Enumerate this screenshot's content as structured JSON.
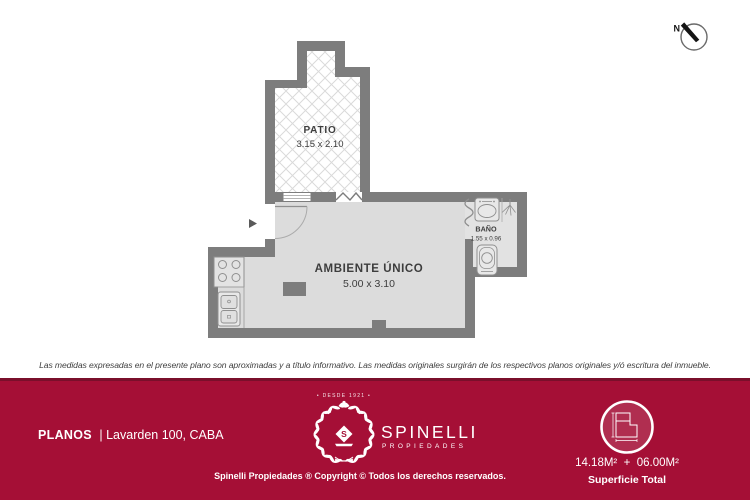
{
  "plan": {
    "compass": "N",
    "rooms": {
      "patio": {
        "name": "PATIO",
        "dims": "3.15 x 2.10"
      },
      "main": {
        "name": "AMBIENTE ÚNICO",
        "dims": "5.00 x 3.10"
      },
      "bath": {
        "name": "BAÑO",
        "dims": "1.55 x 0.96"
      }
    }
  },
  "disclaimer": "Las medidas expresadas en el presente plano son aproximadas y a título informativo. Las medidas originales surgirán de los respectivos planos originales y/ó escritura del inmueble.",
  "footer": {
    "left": {
      "doc_type": "PLANOS",
      "address": "| Lavarden 100, CABA"
    },
    "brand": {
      "since": "• DESDE 1921 •",
      "name": "SPINELLI",
      "sub": "PROPIEDADES",
      "monogram": "S"
    },
    "copyright": "Spinelli Propiedades ® Copyright © Todos los derechos reservados.",
    "surface": {
      "value": "14.18M²  +  06.00M²",
      "label": "Superficie Total"
    }
  },
  "colors": {
    "footer_bg": "#a50f36",
    "footer_accent": "#7a0f2b",
    "wall": "#7d7d7d",
    "floor": "#dcdcdc",
    "hatch": "#dadada"
  }
}
